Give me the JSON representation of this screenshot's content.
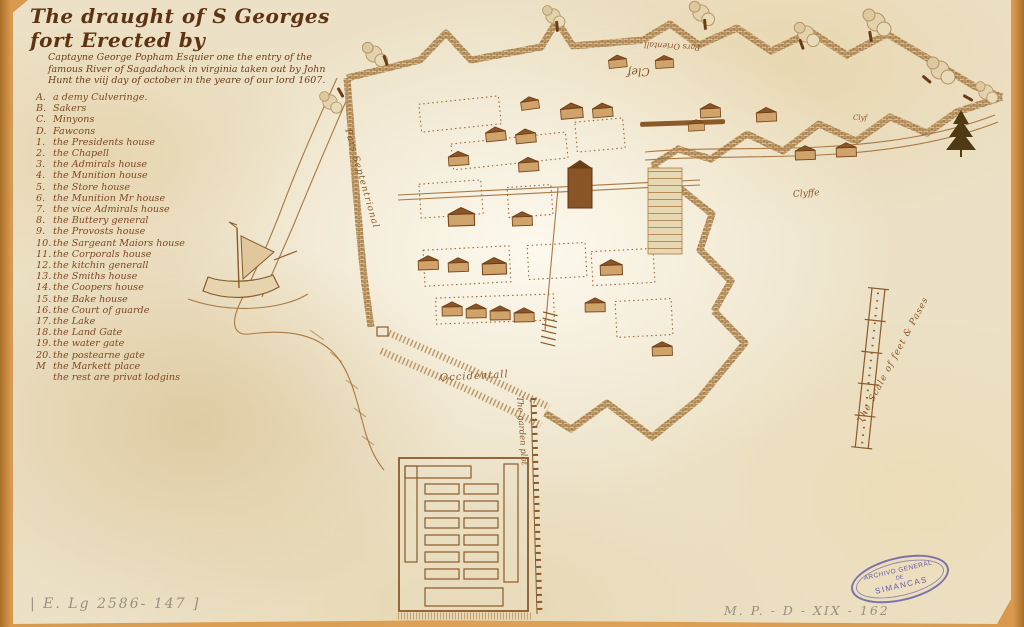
{
  "title": {
    "line1": "The draught of S Georges fort Erected by",
    "line2": "Captayne George Popham Esquier one the entry of the",
    "line3": "famous River of Sagadahock in virginia taken out by John",
    "line4": "Hunt the viij day of october in the yeare of our lord 1607."
  },
  "legend": {
    "items": [
      {
        "key": "A.",
        "label": "a demy Culveringe."
      },
      {
        "key": "B.",
        "label": "Sakers"
      },
      {
        "key": "C.",
        "label": "Minyons"
      },
      {
        "key": "D.",
        "label": "Fawcons"
      },
      {
        "key": "1.",
        "label": "the Presidents house"
      },
      {
        "key": "2.",
        "label": "the Chapell"
      },
      {
        "key": "3.",
        "label": "the Admirals house"
      },
      {
        "key": "4.",
        "label": "the Munition house"
      },
      {
        "key": "5.",
        "label": "the Store house"
      },
      {
        "key": "6.",
        "label": "the Munition Mr house"
      },
      {
        "key": "7.",
        "label": "the vice Admirals house"
      },
      {
        "key": "8.",
        "label": "the Buttery general"
      },
      {
        "key": "9.",
        "label": "the Provosts house"
      },
      {
        "key": "10.",
        "label": "the Sargeant Maiors house"
      },
      {
        "key": "11.",
        "label": "the Corporals house"
      },
      {
        "key": "12.",
        "label": "the kitchin generall"
      },
      {
        "key": "13.",
        "label": "the Smiths house"
      },
      {
        "key": "14.",
        "label": "the Coopers house"
      },
      {
        "key": "15.",
        "label": "the Bake house"
      },
      {
        "key": "16.",
        "label": "the Court of guarde"
      },
      {
        "key": "17.",
        "label": "the Lake"
      },
      {
        "key": "18.",
        "label": "the Land Gate"
      },
      {
        "key": "19.",
        "label": "the water gate"
      },
      {
        "key": "20.",
        "label": "the postearne gate"
      },
      {
        "key": "M",
        "label": "the Markett place"
      },
      {
        "key": "",
        "label": "the rest are privat lodgins"
      }
    ]
  },
  "map_labels": {
    "septentrional": "Pars Septentrional",
    "oriental": "Pars Orientall",
    "clef": "Clef",
    "clyf": "Clyf",
    "clyffe": "Clyffe",
    "occidental": "Occidentall",
    "garden": "The garden plot",
    "scale": "The Scale of feet & Pases"
  },
  "annotations": {
    "shelfmark_left": "| E. Lg 2586- 147 ]",
    "shelfmark_right": "M. P. - D - XIX - 162"
  },
  "stamp": {
    "line1": "ARCHIVO GENERAL",
    "line2": "DE",
    "line3": "SIMANCAS"
  },
  "colors": {
    "paper": "#ece1c6",
    "border": "#d89a4e",
    "ink": "#8a5a2b",
    "title_ink": "#5e3312",
    "stamp": "#584ea2",
    "pencil": "#98907f"
  }
}
